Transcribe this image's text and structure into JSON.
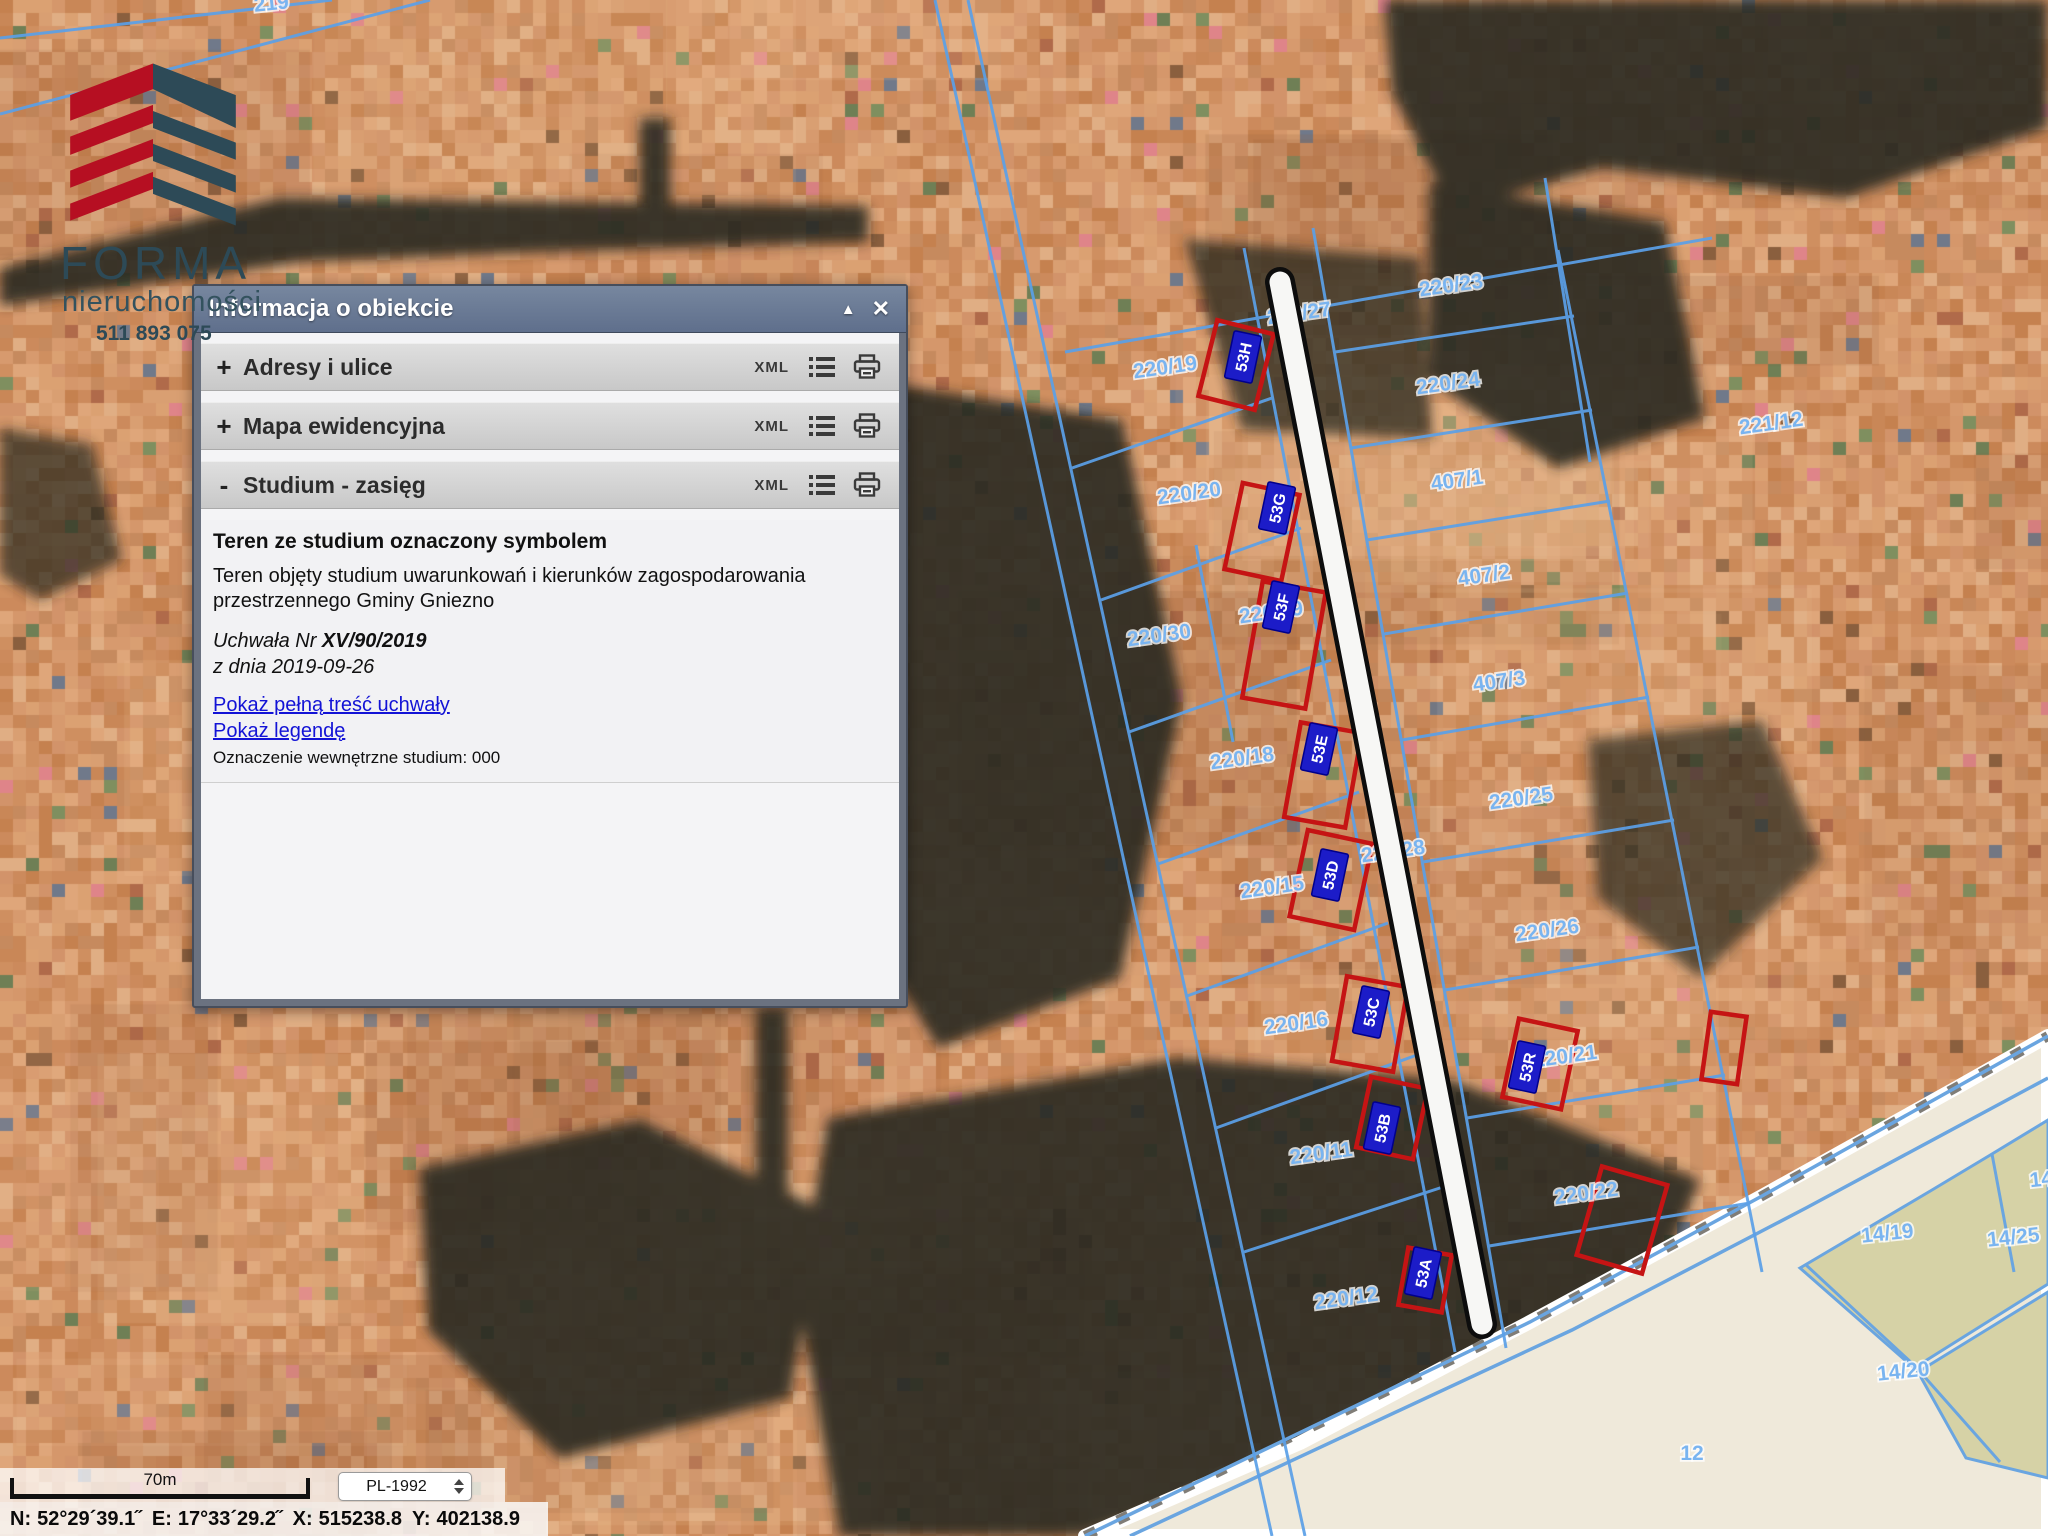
{
  "logo": {
    "name": "FORMA",
    "subtitle": "nieruchomości",
    "phone": "511 893 075",
    "colors": {
      "red": "#b60f22",
      "teal": "#2d4a57"
    }
  },
  "panel": {
    "title": "Informacja o obiekcie",
    "minimize_icon": "▲",
    "close_icon": "✕",
    "sections": [
      {
        "expand": "+",
        "label": "Adresy i ulice",
        "xml": "XML"
      },
      {
        "expand": "+",
        "label": "Mapa ewidencyjna",
        "xml": "XML"
      },
      {
        "expand": "-",
        "label": "Studium - zasięg",
        "xml": "XML"
      }
    ],
    "content": {
      "heading": "Teren ze studium oznaczony symbolem",
      "body": "Teren objęty studium uwarunkowań i kierunków zagospodarowania przestrzennego Gminy Gniezno",
      "resolution_prefix": "Uchwała Nr ",
      "resolution_number": "XV/90/2019",
      "date_line": "z dnia 2019-09-26",
      "link_full_text": "Pokaż pełną treść uchwały",
      "link_legend": "Pokaż legendę",
      "internal_code": "Oznaczenie wewnętrzne studium: 000"
    }
  },
  "statusbar": {
    "scale_label": "70m",
    "crs": "PL-1992",
    "coords": {
      "n": {
        "label": "N:",
        "value": "52°29´39.1˝"
      },
      "e": {
        "label": "E:",
        "value": "17°33´29.2˝"
      },
      "x": {
        "label": "X:",
        "value": "515238.8"
      },
      "y": {
        "label": "Y:",
        "value": "402138.9"
      }
    }
  },
  "map": {
    "colors": {
      "parcel_line": "#5ba0e8",
      "label": "#79b4f0",
      "chip_bg": "#1c1cc8",
      "building_outline": "#c51414",
      "road_fill": "#f7f7f5",
      "road_edge": "#0d0d0d",
      "cream": "#efe9da",
      "olive": "#d6d2a6"
    },
    "parcel_labels": [
      {
        "text": "219",
        "x": 272,
        "y": 10,
        "rot": -6
      },
      {
        "text": "220/23",
        "x": 1452,
        "y": 292,
        "rot": -8
      },
      {
        "text": "220/27",
        "x": 1300,
        "y": 320,
        "rot": -8
      },
      {
        "text": "220/19",
        "x": 1166,
        "y": 374,
        "rot": -8
      },
      {
        "text": "220/24",
        "x": 1449,
        "y": 390,
        "rot": -8
      },
      {
        "text": "221/12",
        "x": 1772,
        "y": 430,
        "rot": -8
      },
      {
        "text": "220/20",
        "x": 1190,
        "y": 500,
        "rot": -8
      },
      {
        "text": "407/1",
        "x": 1458,
        "y": 487,
        "rot": -8
      },
      {
        "text": "407/2",
        "x": 1485,
        "y": 582,
        "rot": -8
      },
      {
        "text": "220/30",
        "x": 1160,
        "y": 642,
        "rot": -8
      },
      {
        "text": "220/29",
        "x": 1272,
        "y": 619,
        "rot": -8
      },
      {
        "text": "407/3",
        "x": 1500,
        "y": 688,
        "rot": -8
      },
      {
        "text": "220/18",
        "x": 1243,
        "y": 765,
        "rot": -8
      },
      {
        "text": "220/25",
        "x": 1522,
        "y": 805,
        "rot": -8
      },
      {
        "text": "220/28",
        "x": 1394,
        "y": 858,
        "rot": -8
      },
      {
        "text": "220/15",
        "x": 1273,
        "y": 894,
        "rot": -8
      },
      {
        "text": "220/26",
        "x": 1548,
        "y": 937,
        "rot": -8
      },
      {
        "text": "220/16",
        "x": 1297,
        "y": 1030,
        "rot": -8
      },
      {
        "text": "220/21",
        "x": 1566,
        "y": 1063,
        "rot": -8
      },
      {
        "text": "220/11",
        "x": 1322,
        "y": 1160,
        "rot": -8
      },
      {
        "text": "220/22",
        "x": 1587,
        "y": 1200,
        "rot": -8
      },
      {
        "text": "220/12",
        "x": 1347,
        "y": 1305,
        "rot": -8
      },
      {
        "text": "14/19",
        "x": 1888,
        "y": 1240,
        "rot": -6
      },
      {
        "text": "14/25",
        "x": 2014,
        "y": 1244,
        "rot": -6
      },
      {
        "text": "14",
        "x": 2042,
        "y": 1186,
        "rot": -6
      },
      {
        "text": "14/20",
        "x": 1904,
        "y": 1378,
        "rot": -6
      },
      {
        "text": "12",
        "x": 1692,
        "y": 1460,
        "rot": 0
      }
    ],
    "building_chips": [
      {
        "text": "53H",
        "x": 1243,
        "y": 357,
        "rot": -78
      },
      {
        "text": "53G",
        "x": 1277,
        "y": 508,
        "rot": -78
      },
      {
        "text": "53F",
        "x": 1281,
        "y": 607,
        "rot": -78
      },
      {
        "text": "53E",
        "x": 1319,
        "y": 749,
        "rot": -78
      },
      {
        "text": "53D",
        "x": 1330,
        "y": 875,
        "rot": -78
      },
      {
        "text": "53C",
        "x": 1371,
        "y": 1012,
        "rot": -78
      },
      {
        "text": "53B",
        "x": 1382,
        "y": 1128,
        "rot": -78
      },
      {
        "text": "53A",
        "x": 1423,
        "y": 1273,
        "rot": -78
      },
      {
        "text": "53R",
        "x": 1527,
        "y": 1067,
        "rot": -78
      }
    ],
    "building_outlines": [
      {
        "cx": 1236,
        "cy": 365,
        "w": 58,
        "h": 78,
        "rot": 14
      },
      {
        "cx": 1262,
        "cy": 532,
        "w": 58,
        "h": 88,
        "rot": 12
      },
      {
        "cx": 1284,
        "cy": 645,
        "w": 64,
        "h": 118,
        "rot": 10
      },
      {
        "cx": 1323,
        "cy": 775,
        "w": 62,
        "h": 96,
        "rot": 10
      },
      {
        "cx": 1331,
        "cy": 880,
        "w": 66,
        "h": 88,
        "rot": 12
      },
      {
        "cx": 1370,
        "cy": 1024,
        "w": 62,
        "h": 86,
        "rot": 10
      },
      {
        "cx": 1392,
        "cy": 1118,
        "w": 58,
        "h": 72,
        "rot": 12
      },
      {
        "cx": 1540,
        "cy": 1064,
        "w": 60,
        "h": 80,
        "rot": 12
      },
      {
        "cx": 1425,
        "cy": 1280,
        "w": 44,
        "h": 58,
        "rot": 10
      },
      {
        "cx": 1724,
        "cy": 1048,
        "w": 36,
        "h": 68,
        "rot": 8
      },
      {
        "cx": 1622,
        "cy": 1220,
        "w": 68,
        "h": 92,
        "rot": 16
      }
    ]
  }
}
